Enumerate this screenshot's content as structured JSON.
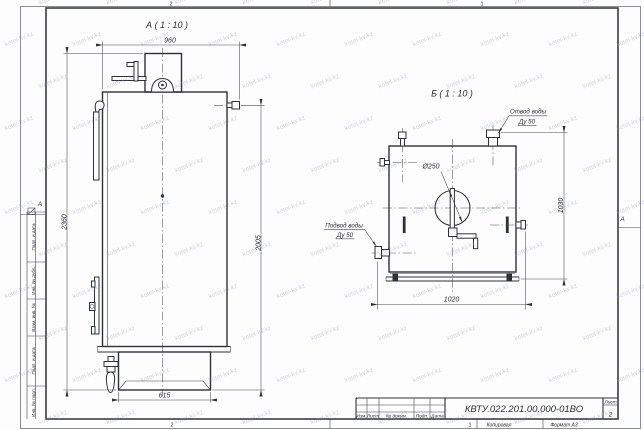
{
  "sheet": {
    "zones": {
      "top_left": "2",
      "top_right": "1",
      "bottom_left": "2",
      "bottom_right": "1"
    },
    "fold_marks": {
      "left": "А",
      "right": "А"
    },
    "sidebar": {
      "labels": [
        "Подп. и дата",
        "Инв. № дубл.",
        "Взам. инв. №",
        "Подп. и дата",
        "Инв. № подл."
      ]
    },
    "footer": {
      "copied_by": "Копировал",
      "format": "Формат А3"
    }
  },
  "title_block": {
    "doc_number": "КВТУ.022.201.00.000-01ВО",
    "sheet_label": "Лист",
    "sheet_number": "2",
    "columns": [
      "Изм.",
      "Лист",
      "№ докум.",
      "Подп.",
      "Дата"
    ]
  },
  "view_a": {
    "title": "А ( 1 : 10 )",
    "dim_width": "960",
    "dim_height_overall": "2360",
    "dim_height_nozzle": "2005",
    "dim_base": "615"
  },
  "view_b": {
    "title": "Б ( 1 : 10 )",
    "dim_width": "1020",
    "dim_height": "1030",
    "dim_hole": "Ø250",
    "label_outlet": [
      "Отвод воды",
      "Ду 50"
    ],
    "label_inlet": [
      "Подвод воды",
      "Ду 50"
    ]
  },
  "watermark": {
    "text": "kotel-kv.kz"
  }
}
